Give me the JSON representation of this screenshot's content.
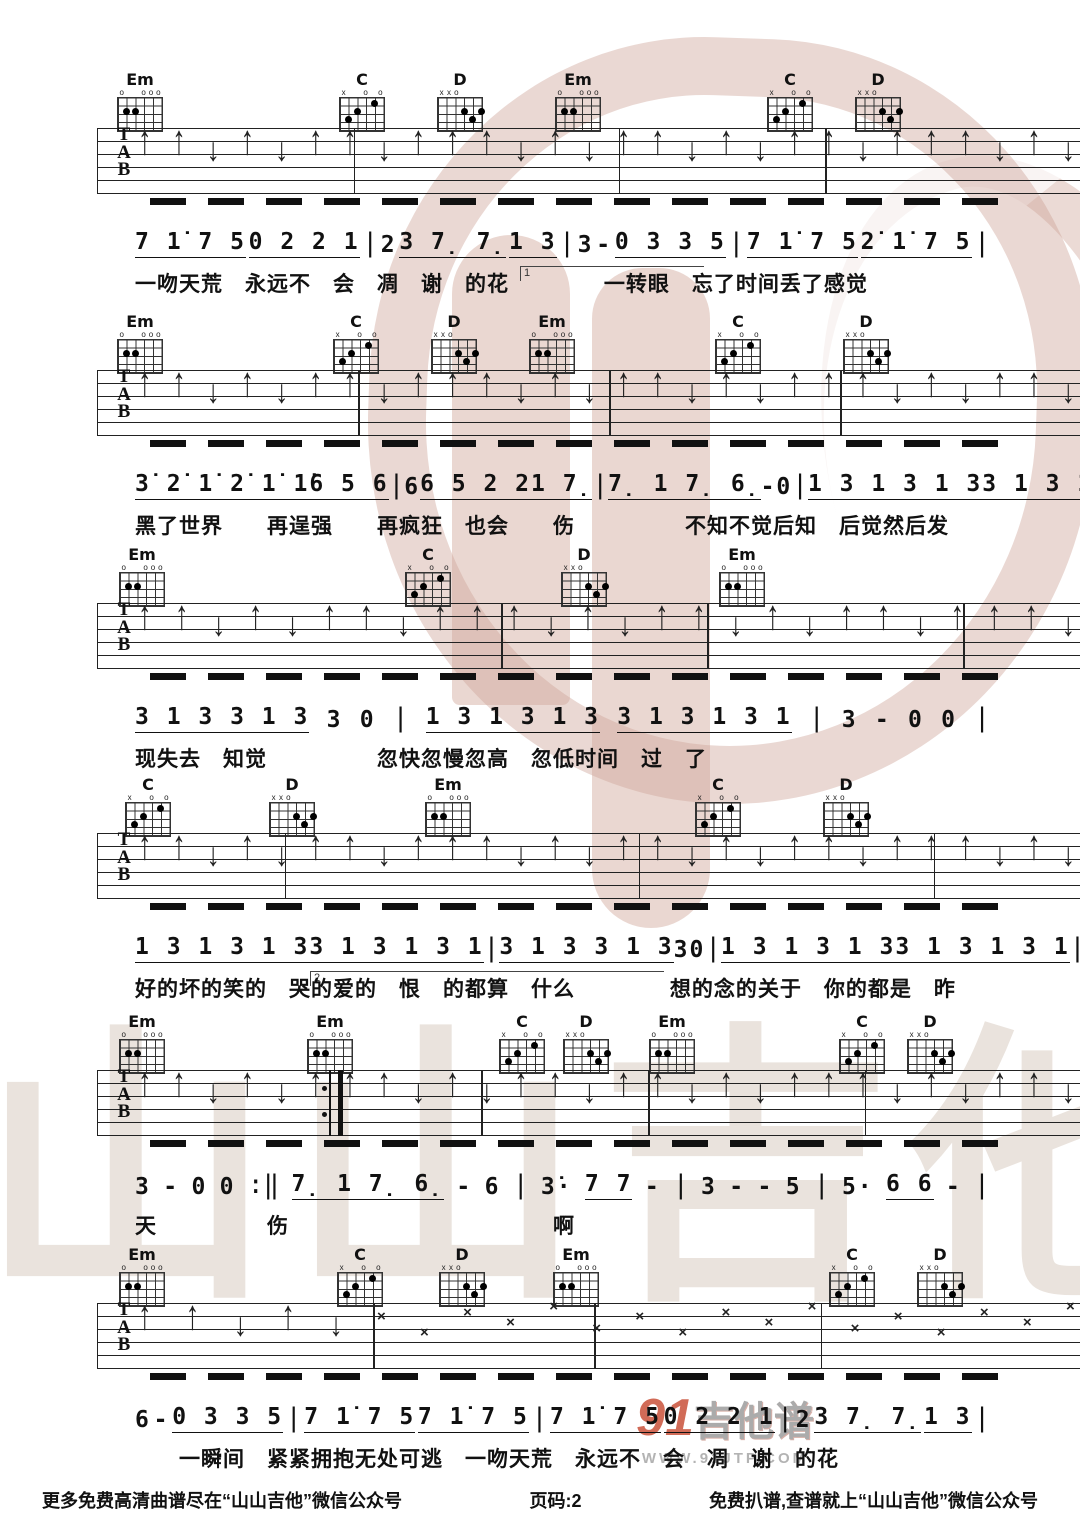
{
  "page": {
    "footer_left": "更多免费高清曲谱尽在“山山吉他”微信公众号",
    "page_label": "页码:2",
    "footer_right": "免费扒谱,查谱就上“山山吉他”微信公众号",
    "watermark_name": "91吉他谱",
    "watermark_91": "91",
    "watermark_jtp": "吉他谱",
    "watermark_url": "WWW.91JTP.COM",
    "watermark_big_text": "山山吉他",
    "colors": {
      "ink": "#111111",
      "watermark_pink": "#cda396",
      "watermark_gray": "#eae3dd",
      "logo_red": "#c23a20"
    }
  },
  "chord_shapes": {
    "Em": {
      "markers": [
        "o",
        "",
        "",
        "o",
        "o",
        "o"
      ],
      "dots": [
        [
          1,
          2
        ],
        [
          2,
          2
        ]
      ]
    },
    "C": {
      "markers": [
        "x",
        "",
        "",
        "o",
        "",
        "o"
      ],
      "dots": [
        [
          1,
          3
        ],
        [
          2,
          2
        ],
        [
          4,
          1
        ]
      ]
    },
    "D": {
      "markers": [
        "x",
        "x",
        "o",
        "",
        "",
        ""
      ],
      "dots": [
        [
          3,
          2
        ],
        [
          5,
          2
        ],
        [
          4,
          3
        ]
      ]
    }
  },
  "systems": [
    {
      "top": 70,
      "chords": [
        {
          "name": "Em",
          "x": 140
        },
        {
          "name": "C",
          "x": 362
        },
        {
          "name": "D",
          "x": 460
        },
        {
          "name": "Em",
          "x": 578
        },
        {
          "name": "C",
          "x": 790
        },
        {
          "name": "D",
          "x": 878
        }
      ],
      "bars": [
        26,
        53,
        74
      ],
      "arrows": "↑↑↓↑↓↑↑↓↑↑↑↓↑↓↑↑↓↑↓↑↑↓↑↑↑↓↑↓",
      "numbers": [
        {
          "t": "7 1̇ 7 5",
          "u": 1
        },
        {
          "t": "0 2 2 1",
          "u": 1
        },
        {
          "t": "|",
          "b": 1
        },
        {
          "t": "2"
        },
        {
          "t": "3 7̣ 7̣",
          "u": 1
        },
        {
          "t": "1 3",
          "u": 1
        },
        {
          "t": "|",
          "b": 1
        },
        {
          "t": "3"
        },
        {
          "t": "-"
        },
        {
          "t": "0 3 3 5",
          "u": 1
        },
        {
          "t": "|",
          "b": 1
        },
        {
          "t": "7 1̇ 7 5",
          "u": 1
        },
        {
          "t": "2̇ 1̇ 7 5",
          "u": 1
        },
        {
          "t": "|",
          "b": 1
        }
      ],
      "volta": {
        "label": "1",
        "x": 520,
        "w": 180
      },
      "lyrics": "一吻天荒　永远不　会　凋　谢　的花　　　　 一转眼　忘了时间丢了感觉"
    },
    {
      "top": 312,
      "chords": [
        {
          "name": "Em",
          "x": 140
        },
        {
          "name": "C",
          "x": 356
        },
        {
          "name": "D",
          "x": 454
        },
        {
          "name": "Em",
          "x": 552
        },
        {
          "name": "C",
          "x": 738
        },
        {
          "name": "D",
          "x": 866
        }
      ],
      "bars": [
        26.5,
        52,
        75.5
      ],
      "arrows": "↑↑↓↑↓↑↑↓↑↑↑↓↑↓↑↑↓↑↓↑↑↑↓↑↓↑↑↓",
      "numbers": [
        {
          "t": "3̇ 2̇ 1̇ 2̇ 1̇ 1̇",
          "u": 1
        },
        {
          "t": "6 5 6",
          "u": 1
        },
        {
          "t": "|",
          "b": 1
        },
        {
          "t": "6"
        },
        {
          "t": "6 5 2 2",
          "u": 1
        },
        {
          "t": "1 7̣",
          "u": 1
        },
        {
          "t": "|",
          "b": 1
        },
        {
          "t": "7̣ 1 7̣ 6̣",
          "u": 1
        },
        {
          "t": "-"
        },
        {
          "t": "0"
        },
        {
          "t": "|",
          "b": 1
        },
        {
          "t": "1 3 1 3 1 3",
          "u": 1
        },
        {
          "t": "3 1 3 1 3 1",
          "u": 1
        },
        {
          "t": "|",
          "b": 1
        }
      ],
      "lyrics": "黑了世界　　再逞强　　再疯狂　也会　　伤　　　　　不知不觉后知　后觉然后发"
    },
    {
      "top": 545,
      "chords": [
        {
          "name": "Em",
          "x": 142
        },
        {
          "name": "C",
          "x": 428
        },
        {
          "name": "D",
          "x": 584
        },
        {
          "name": "Em",
          "x": 742
        }
      ],
      "bars": [
        41,
        62,
        88
      ],
      "arrows": "↑↑↓↑↓↑↑↓↑↑↑↓↑↓↑↑↓↑↓↑↑↓↑↑↑↓",
      "numbers": [
        {
          "t": "3 1 3 3 1 3",
          "u": 1
        },
        {
          "t": "3"
        },
        {
          "t": "0"
        },
        {
          "t": "|",
          "b": 1
        },
        {
          "t": "1 3 1 3 1 3",
          "u": 1
        },
        {
          "t": "3 1 3 1 3 1",
          "u": 1
        },
        {
          "t": "|",
          "b": 1
        },
        {
          "t": "3"
        },
        {
          "t": "-"
        },
        {
          "t": "0"
        },
        {
          "t": "0"
        },
        {
          "t": "|",
          "b": 1
        }
      ],
      "lyrics": "现失去　知觉　　　　　忽快忽慢忽高　忽低时间　过　了"
    },
    {
      "top": 775,
      "chords": [
        {
          "name": "C",
          "x": 148
        },
        {
          "name": "D",
          "x": 292
        },
        {
          "name": "Em",
          "x": 448
        },
        {
          "name": "C",
          "x": 718
        },
        {
          "name": "D",
          "x": 846
        }
      ],
      "bars": [
        19,
        55,
        85
      ],
      "arrows": "↑↑↓↑↓↑↑↓↑↑↑↓↑↓↑↑↓↑↓↑↑↓↑↑↑↓↑↓",
      "numbers": [
        {
          "t": "1 3 1 3 1 3",
          "u": 1
        },
        {
          "t": "3 1 3 1 3 1",
          "u": 1
        },
        {
          "t": "|",
          "b": 1
        },
        {
          "t": "3 1 3 3 1 3",
          "u": 1
        },
        {
          "t": "3"
        },
        {
          "t": "0"
        },
        {
          "t": "|",
          "b": 1
        },
        {
          "t": "1 3 1 3 1 3",
          "u": 1
        },
        {
          "t": "3 1 3 1 3 1",
          "u": 1
        },
        {
          "t": "|",
          "b": 1
        }
      ],
      "volta": {
        "label": "2",
        "x": 310,
        "w": 350
      },
      "lyrics": "好的坏的笑的　哭的爱的　恨　的都算　什么　　　　 想的念的关于　你的都是　昨"
    },
    {
      "top": 1012,
      "chords": [
        {
          "name": "Em",
          "x": 142
        },
        {
          "name": "Em",
          "x": 330
        },
        {
          "name": "C",
          "x": 522
        },
        {
          "name": "D",
          "x": 586
        },
        {
          "name": "Em",
          "x": 672
        },
        {
          "name": "C",
          "x": 862
        },
        {
          "name": "D",
          "x": 930
        }
      ],
      "bars": [
        39,
        56,
        78
      ],
      "repeat_bar": 23.5,
      "arrows": "↑↑↓↑↓↑↑↑↓↑↓↑↑↓↑↑↓↑↓↑↑↑↓↑↓↑↑↓",
      "numbers": [
        {
          "t": "3"
        },
        {
          "t": "-"
        },
        {
          "t": "0"
        },
        {
          "t": "0"
        },
        {
          "t": ":‖",
          "b": 1
        },
        {
          "t": "7̣ 1 7̣ 6̣",
          "u": 1
        },
        {
          "t": "-"
        },
        {
          "t": "6"
        },
        {
          "t": "|",
          "b": 1
        },
        {
          "t": "3̇·"
        },
        {
          "t": "7 7",
          "u": 1
        },
        {
          "t": "-"
        },
        {
          "t": "|",
          "b": 1
        },
        {
          "t": "3"
        },
        {
          "t": "-"
        },
        {
          "t": "-"
        },
        {
          "t": "5"
        },
        {
          "t": "|",
          "b": 1
        },
        {
          "t": "5·"
        },
        {
          "t": "6 6",
          "u": 1
        },
        {
          "t": "-"
        },
        {
          "t": "|",
          "b": 1
        }
      ],
      "lyrics": "天　　　　　伤　　　　　　　　　　　　啊"
    },
    {
      "top": 1245,
      "chords": [
        {
          "name": "Em",
          "x": 142
        },
        {
          "name": "C",
          "x": 360
        },
        {
          "name": "D",
          "x": 462
        },
        {
          "name": "Em",
          "x": 576
        },
        {
          "name": "C",
          "x": 852
        },
        {
          "name": "D",
          "x": 940
        }
      ],
      "bars": [
        28,
        50.5,
        73.5
      ],
      "arrows": "↑↑↓↑↓×××××××××××××××××",
      "numbers": [
        {
          "t": "6"
        },
        {
          "t": "-"
        },
        {
          "t": "0 3 3 5",
          "u": 1
        },
        {
          "t": "|",
          "b": 1
        },
        {
          "t": "7 1̇ 7 5",
          "u": 1
        },
        {
          "t": "7 1̇ 7 5",
          "u": 1
        },
        {
          "t": "|",
          "b": 1
        },
        {
          "t": "7 1̇ 7 5",
          "u": 1
        },
        {
          "t": "0 2 2 1",
          "u": 1
        },
        {
          "t": "|",
          "b": 1
        },
        {
          "t": "2"
        },
        {
          "t": "3 7̣ 7̣",
          "u": 1
        },
        {
          "t": "1 3",
          "u": 1
        },
        {
          "t": "|",
          "b": 1
        }
      ],
      "lyrics": "　　一瞬间　紧紧拥抱无处可逃　一吻天荒　永远不　会　凋　谢　的花"
    }
  ]
}
